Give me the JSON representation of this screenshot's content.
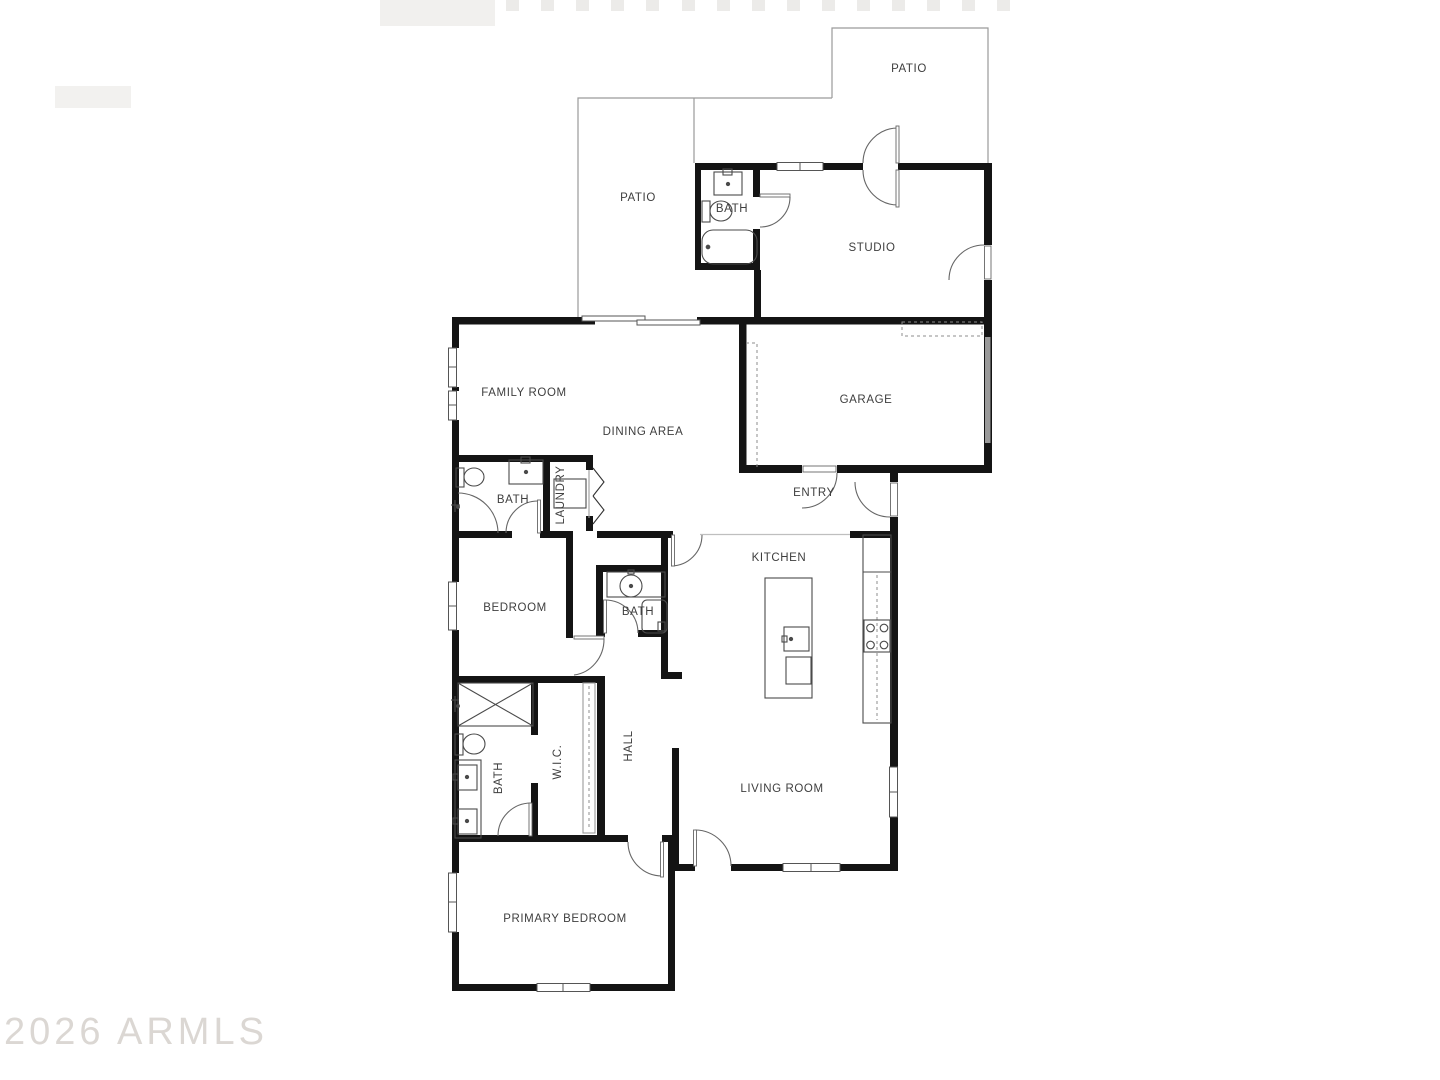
{
  "watermark": "2026 ARMLS",
  "colors": {
    "wall": "#141414",
    "line": "#666666",
    "thin": "#9a9a9a",
    "fixture": "#4a4a4a",
    "label": "#3e3e3e",
    "garage_door": "#9a9a9a",
    "watermark": "#dbd7d3"
  },
  "rooms": {
    "patio_top": "PATIO",
    "patio_left": "PATIO",
    "studio_bath": "BATH",
    "studio": "STUDIO",
    "family_room": "FAMILY ROOM",
    "dining_area": "DINING AREA",
    "garage": "GARAGE",
    "hall_bath": "BATH",
    "laundry": "LAUNDRY",
    "entry": "ENTRY",
    "bedroom": "BEDROOM",
    "middle_bath": "BATH",
    "kitchen": "KITCHEN",
    "primary_bath": "BATH",
    "wic": "W.I.C.",
    "hall": "HALL",
    "living_room": "LIVING ROOM",
    "primary_bedroom": "PRIMARY BEDROOM"
  }
}
